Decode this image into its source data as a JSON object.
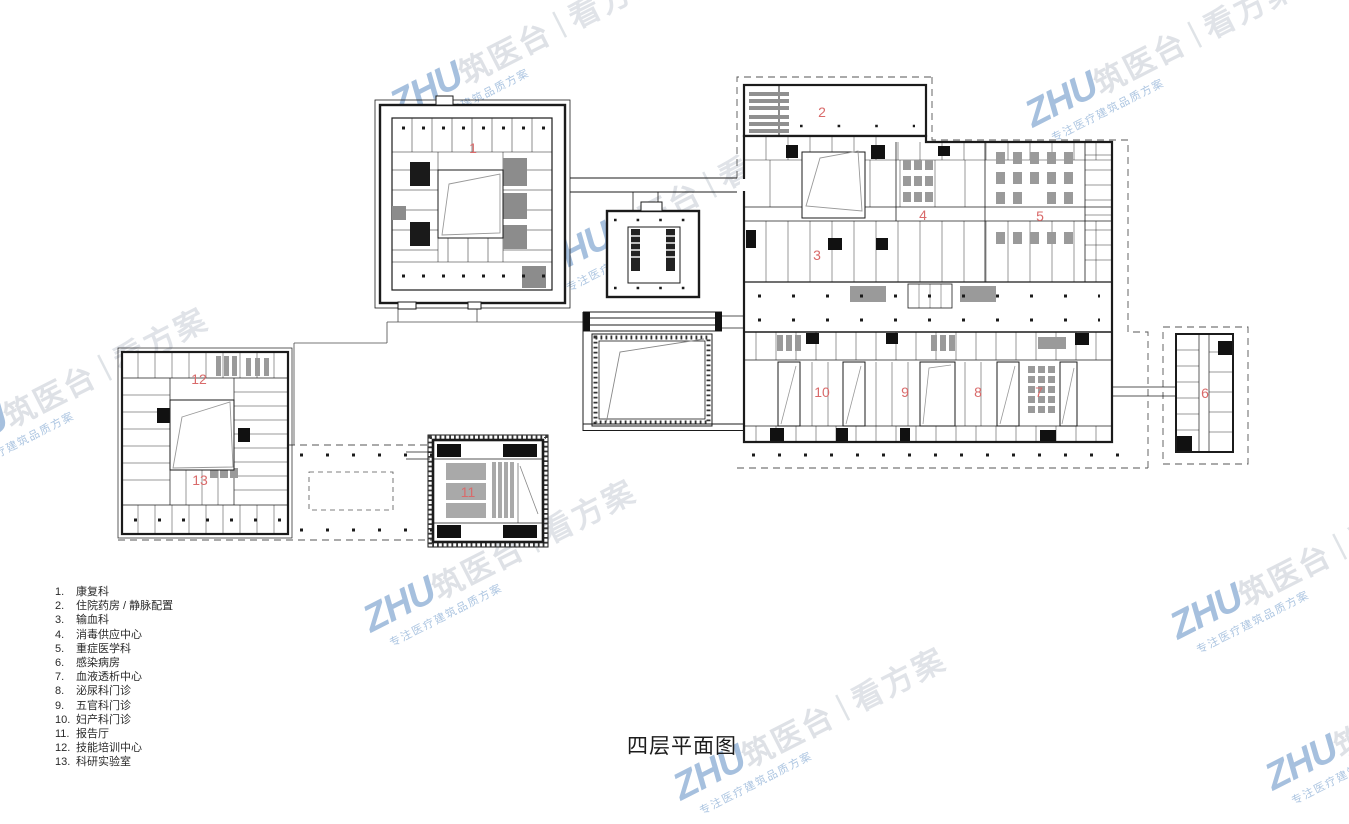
{
  "page": {
    "title": "四层平面图",
    "background": "#ffffff"
  },
  "legend": {
    "items": [
      {
        "n": "1.",
        "label": "康复科"
      },
      {
        "n": "2.",
        "label": "住院药房 / 静脉配置"
      },
      {
        "n": "3.",
        "label": "输血科"
      },
      {
        "n": "4.",
        "label": "消毒供应中心"
      },
      {
        "n": "5.",
        "label": "重症医学科"
      },
      {
        "n": "6.",
        "label": "感染病房"
      },
      {
        "n": "7.",
        "label": "血液透析中心"
      },
      {
        "n": "8.",
        "label": "泌尿科门诊"
      },
      {
        "n": "9.",
        "label": "五官科门诊"
      },
      {
        "n": "10.",
        "label": "妇产科门诊"
      },
      {
        "n": "11.",
        "label": "报告厅"
      },
      {
        "n": "12.",
        "label": "技能培训中心"
      },
      {
        "n": "13.",
        "label": "科研实验室"
      }
    ]
  },
  "plan": {
    "label_color": "#d96a6a",
    "labels": [
      {
        "n": "1",
        "x": 473,
        "y": 148
      },
      {
        "n": "2",
        "x": 822,
        "y": 112
      },
      {
        "n": "3",
        "x": 817,
        "y": 255
      },
      {
        "n": "4",
        "x": 923,
        "y": 215
      },
      {
        "n": "5",
        "x": 1040,
        "y": 216
      },
      {
        "n": "6",
        "x": 1205,
        "y": 393
      },
      {
        "n": "7",
        "x": 1039,
        "y": 392
      },
      {
        "n": "8",
        "x": 978,
        "y": 392
      },
      {
        "n": "9",
        "x": 905,
        "y": 392
      },
      {
        "n": "10",
        "x": 822,
        "y": 392
      },
      {
        "n": "11",
        "x": 468,
        "y": 492
      },
      {
        "n": "12",
        "x": 199,
        "y": 379
      },
      {
        "n": "13",
        "x": 200,
        "y": 480
      }
    ]
  },
  "watermark": {
    "brand_latin": "ZHU",
    "brand_cn": "筑医台",
    "separator": "|",
    "product": "看方案",
    "tagline": "专注医疗建筑品质方案",
    "accent": "#4d82be",
    "positions": [
      {
        "x": 1028,
        "y": 95
      },
      {
        "x": 393,
        "y": 85
      },
      {
        "x": 543,
        "y": 245
      },
      {
        "x": -62,
        "y": 428
      },
      {
        "x": 366,
        "y": 600
      },
      {
        "x": 1173,
        "y": 607
      },
      {
        "x": 676,
        "y": 768
      },
      {
        "x": 1268,
        "y": 758
      }
    ]
  }
}
